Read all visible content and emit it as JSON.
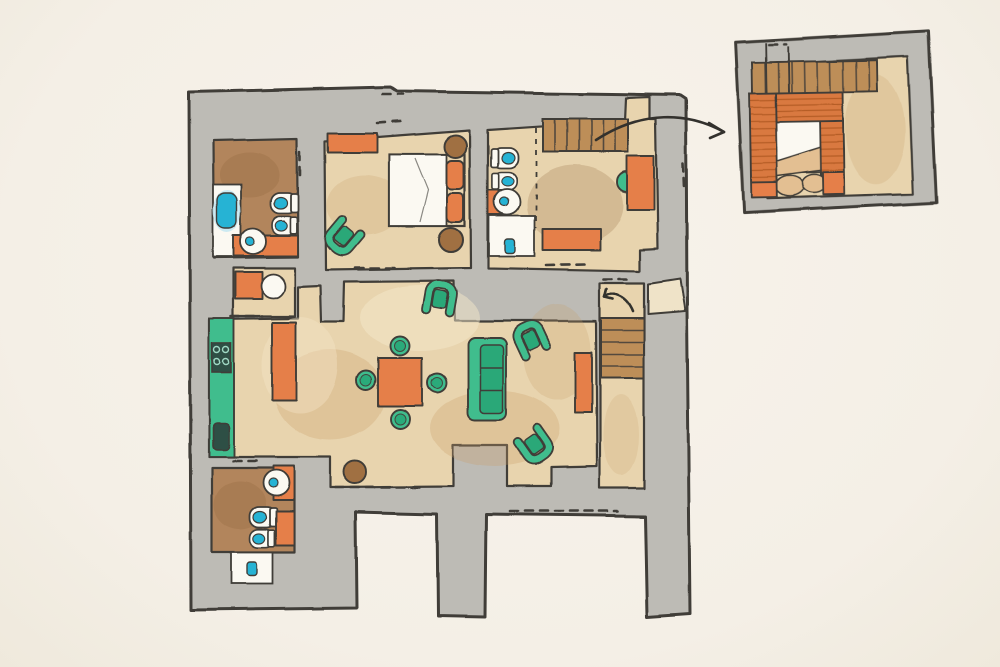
{
  "page": {
    "kind": "hand-drawn watercolor apartment floor plan with detail callout",
    "visible_text": ""
  },
  "colors": {
    "paper": "#f4efe6",
    "paperLight": "#f8f3eb",
    "wall": "#bdbbb5",
    "outline": "#3f3d38",
    "floorTan": "#e8d4ae",
    "floorBrown": "#b2855b",
    "floorPale": "#efe3c8",
    "white": "#fbf9f2",
    "orange": "#e57f49",
    "green": "#41bd8d",
    "greenDeep": "#2aa878",
    "teal": "#25b3d4",
    "tealGlow": "#c3e7f2",
    "stairBrown": "#bd8e59",
    "brickOrange": "#d9793f",
    "brickLine": "#a8541f",
    "stoolBrown": "#a06f42",
    "stoneTan": "#e3bf92",
    "appliance": "#2f4f44",
    "arrow": "#33312d",
    "washDark": "#c9a06b",
    "washBrown": "#8a5f38",
    "washLight": "#f4e7c9"
  },
  "plan": {
    "rooms": [
      {
        "name": "ensuite-bathroom",
        "position": "top-left",
        "items": [
          "bathtub",
          "toilet",
          "bidet",
          "round-washbasin",
          "vanity-counter"
        ]
      },
      {
        "name": "bedroom",
        "position": "top-center",
        "items": [
          "dresser",
          "double-bed",
          "pillows",
          "nightstand",
          "nightstand",
          "armchair"
        ]
      },
      {
        "name": "master-room",
        "position": "top-right",
        "items": [
          "stair-strip",
          "toilet",
          "bidet",
          "round-washbasin",
          "shower",
          "desk",
          "desk-chair",
          "low-cabinet"
        ]
      },
      {
        "name": "kitchen",
        "position": "middle-left",
        "items": [
          "counter-run",
          "hob",
          "kitchen-sink",
          "island-counter",
          "utility-counter",
          "utility-basin"
        ]
      },
      {
        "name": "living-dining-room",
        "position": "center",
        "items": [
          "square-dining-table",
          "stool",
          "stool",
          "stool",
          "stool",
          "sofa",
          "armchair",
          "armchair",
          "armchair",
          "sideboard",
          "side-table"
        ]
      },
      {
        "name": "stair-hall",
        "position": "right",
        "items": [
          "staircase",
          "direction-arrow"
        ]
      },
      {
        "name": "entry-porch",
        "position": "right-edge",
        "items": []
      },
      {
        "name": "bathroom",
        "position": "bottom-left",
        "items": [
          "round-washbasin",
          "vanity-counter",
          "toilet",
          "bidet",
          "cabinet",
          "shower"
        ]
      }
    ],
    "doors": "dashed-openings",
    "legs": [
      "bottom-left-wing",
      "bottom-middle-pier",
      "bottom-right-pier"
    ]
  },
  "inset": {
    "name": "detail-callout",
    "position": "top-right",
    "depicts": [
      "stair-strip",
      "brick-fireplace-hearth",
      "stone-hearth-floor"
    ],
    "connector": "curved-arrow"
  }
}
